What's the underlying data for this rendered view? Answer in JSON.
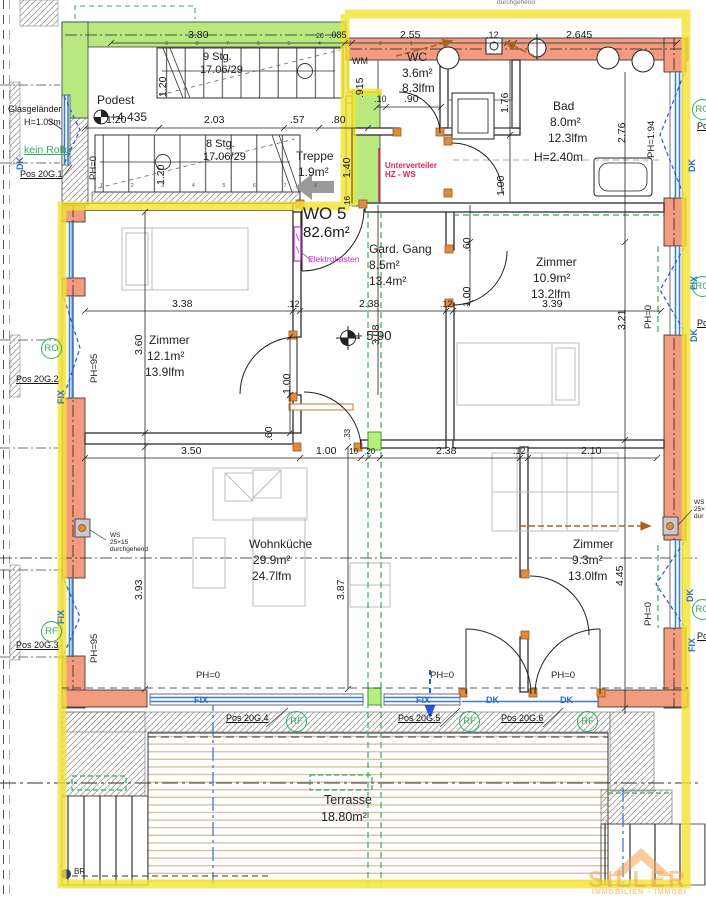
{
  "colors": {
    "highlight_yellow": "#f2e430",
    "wall_green": "#b8e87f",
    "wall_coral": "#f29b80",
    "window_blue": "#3a7fd5",
    "dashed_blue": "#2457e0",
    "dashed_green": "#2fae5e",
    "door_frame_orange": "#e08b3d",
    "note_red": "#e0254d",
    "note_magenta": "#bb2fd0",
    "arrow_brown": "#a9631e",
    "watermark_orange": "#f2a24f"
  },
  "unit": {
    "name": "WO 5",
    "area": "82.6m²"
  },
  "rooms": {
    "podest": {
      "name": "Podest"
    },
    "treppe": {
      "name": "Treppe",
      "area": "1.9m²"
    },
    "wc": {
      "name": "WC",
      "area": "3.6m²",
      "lfm": "8.3lfm"
    },
    "bad": {
      "name": "Bad",
      "area": "8.0m²",
      "lfm": "12.3lfm",
      "height": "H=2.40m"
    },
    "gang": {
      "name": "Gard. Gang",
      "area": "8.5m²",
      "lfm": "13.4m²"
    },
    "zimmer1": {
      "name": "Zimmer",
      "area": "12.1m²",
      "lfm": "13.9lfm"
    },
    "zimmer2": {
      "name": "Zimmer",
      "area": "10.9m²",
      "lfm": "13.2lfm"
    },
    "zimmer3": {
      "name": "Zimmer",
      "area": "9.3m²",
      "lfm": "13.0lfm"
    },
    "wohnkueche": {
      "name": "Wohnküche",
      "area": "29.9m²",
      "lfm": "24.7lfm"
    },
    "terrasse": {
      "name": "Terrasse",
      "area": "18.80m²"
    }
  },
  "stairs": {
    "up_label": "9 Stg.",
    "up_ratio": "17.06/29",
    "down_label": "8 Stg.",
    "down_ratio": "17.06/29",
    "nums_up": "9 8 7 6 5 4 3 2 1",
    "nums_down": "1 2 3 4 5 6 7 8"
  },
  "levels": {
    "podest": "+4.435",
    "floor": "+ 5.90"
  },
  "dims": {
    "top": [
      "3.80",
      "20",
      ".085",
      "2.55",
      ".12",
      "2.645"
    ],
    "stair": [
      "1.20",
      "2.03",
      ".57",
      ".80"
    ],
    "wc_door": [
      ".10",
      ".90"
    ],
    "mid": [
      "3.38",
      ".12",
      "2.38",
      ".12",
      "3.39"
    ],
    "lower": [
      "3.50",
      "1.00",
      ".10",
      ".20",
      "2.38",
      ".12",
      "2.10"
    ],
    "vert": [
      "1.20",
      ".915",
      "1.20",
      "1.40",
      "1.76",
      "1.00",
      "2.76",
      "3.21",
      ".60",
      "1.00",
      "3.60",
      "3.08",
      "1.00",
      ".60",
      "3.93",
      "3.87",
      "4.45",
      ".33",
      ".16"
    ]
  },
  "ph": [
    "PH=0",
    "PH=95",
    "PH=95",
    "PH=1.94",
    "PH=0",
    "PH=0",
    "PH=0",
    "PH=0",
    "PH=0"
  ],
  "win": [
    "DK",
    "FIX",
    "FIX",
    "DK",
    "FIX",
    "DK",
    "DK",
    "FIX",
    "FIX",
    "FIX",
    "DK",
    "DK"
  ],
  "pos": [
    "Pos 20G.1",
    "Pos 20G.2",
    "Pos 20G.3",
    "Pos 20G.4",
    "Pos 20G.5",
    "Pos 20G.6",
    "Po",
    "Po",
    "Po"
  ],
  "badges": [
    "RO",
    "RF",
    "RF",
    "RF",
    "RF",
    "RO",
    "RO",
    "RO"
  ],
  "ann": {
    "glas": "Glasgeländer",
    "glas_h": "H=1.03m",
    "kein_rollo": "kein Rollo",
    "wm": "WM",
    "elektro": "Elektrokasten",
    "unterverteiler": "Unterverteiler",
    "hz_ws": "HZ - WS",
    "ws": "WS",
    "ws_size": "25×15",
    "ws_note": "durchgehend",
    "ws2": "WS",
    "ws2_size": "25×",
    "ws2_note": "dur",
    "top_note": "durchgehend",
    "br": "BR"
  },
  "watermark": {
    "name": "SILLER",
    "sub": "IMMOBILIEN – IMMOBI"
  }
}
